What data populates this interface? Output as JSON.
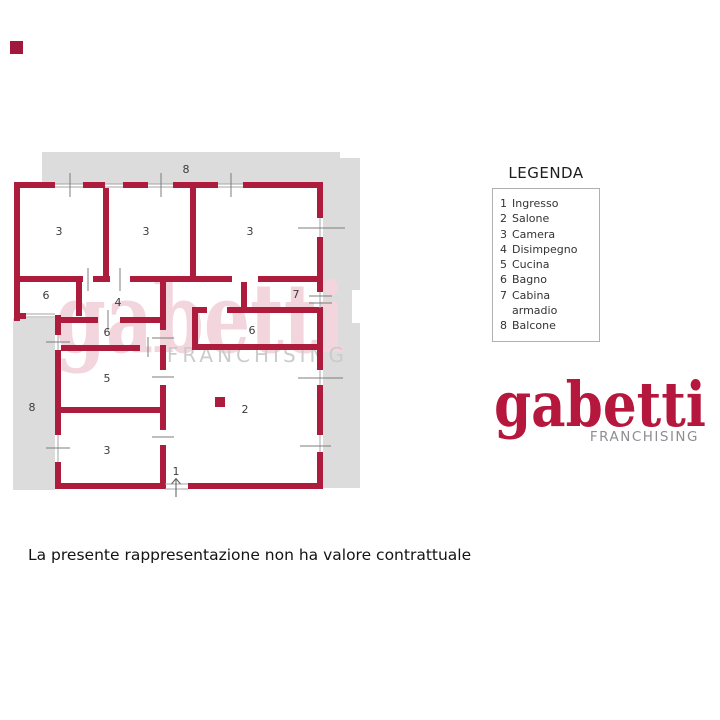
{
  "corner_mark": {
    "color": "#a0193a"
  },
  "legend": {
    "title": "LEGENDA",
    "items": [
      {
        "num": "1",
        "label": "Ingresso"
      },
      {
        "num": "2",
        "label": "Salone"
      },
      {
        "num": "3",
        "label": "Camera"
      },
      {
        "num": "4",
        "label": "Disimpegno"
      },
      {
        "num": "5",
        "label": "Cucina"
      },
      {
        "num": "6",
        "label": "Bagno"
      },
      {
        "num": "7",
        "label": "Cabina armadio"
      },
      {
        "num": "8",
        "label": "Balcone"
      }
    ]
  },
  "logo": {
    "text": "gabetti",
    "subtext": "FRANCHISING",
    "color": "#b5173d",
    "subcolor": "#8d8e92"
  },
  "watermark": {
    "text": "gabetti",
    "subtext": "FRANCHISING",
    "color": "#f2d5dd",
    "subcolor": "#cbcbcb"
  },
  "plan": {
    "wall_color": "#ad1c3c",
    "balcony_color": "#dcdcdc",
    "label_color": "#3c3c3c",
    "labels": [
      {
        "text": "8",
        "x": 186,
        "y": 173
      },
      {
        "text": "3",
        "x": 59,
        "y": 235
      },
      {
        "text": "3",
        "x": 146,
        "y": 235
      },
      {
        "text": "3",
        "x": 250,
        "y": 235
      },
      {
        "text": "6",
        "x": 46,
        "y": 299
      },
      {
        "text": "4",
        "x": 118,
        "y": 306
      },
      {
        "text": "7",
        "x": 296,
        "y": 298
      },
      {
        "text": "6",
        "x": 107,
        "y": 336
      },
      {
        "text": "6",
        "x": 252,
        "y": 334
      },
      {
        "text": "8",
        "x": 32,
        "y": 411
      },
      {
        "text": "5",
        "x": 107,
        "y": 382
      },
      {
        "text": "3",
        "x": 107,
        "y": 454
      },
      {
        "text": "2",
        "x": 245,
        "y": 413
      },
      {
        "text": "1",
        "x": 176,
        "y": 475
      }
    ]
  },
  "disclaimer": {
    "text": "La presente rappresentazione non ha valore contrattuale"
  }
}
